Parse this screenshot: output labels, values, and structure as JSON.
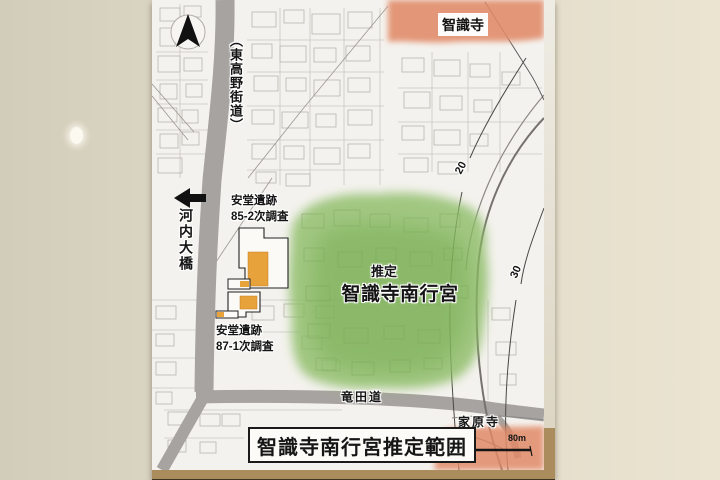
{
  "labels": {
    "temple_top": "智識寺",
    "road_vertical": "（東高野街道）",
    "bridge_vertical": "河内大橋",
    "site85_line1": "安堂遺跡",
    "site85_line2": "85-2次調査",
    "site87_line1": "安堂遺跡",
    "site87_line2": "87-1次調査",
    "estimated": "推定",
    "palace": "智識寺南行宮",
    "contour_20": "20",
    "contour_30": "30",
    "road_tatsuta": "竜田道",
    "temple_bottom": "家原寺"
  },
  "scale_bar": {
    "start": "0",
    "end": "80m"
  },
  "caption": "智識寺南行宮推定範囲",
  "colors": {
    "highlight_green": "#8abb64",
    "temple_orange": "#e18a67",
    "excavation_orange": "#e8a23c",
    "road_gray": "#a7a3a0",
    "frame_tan": "#ab8c5d",
    "wall_beige": "#ded8c6",
    "paper_white": "#f4f2ee"
  }
}
